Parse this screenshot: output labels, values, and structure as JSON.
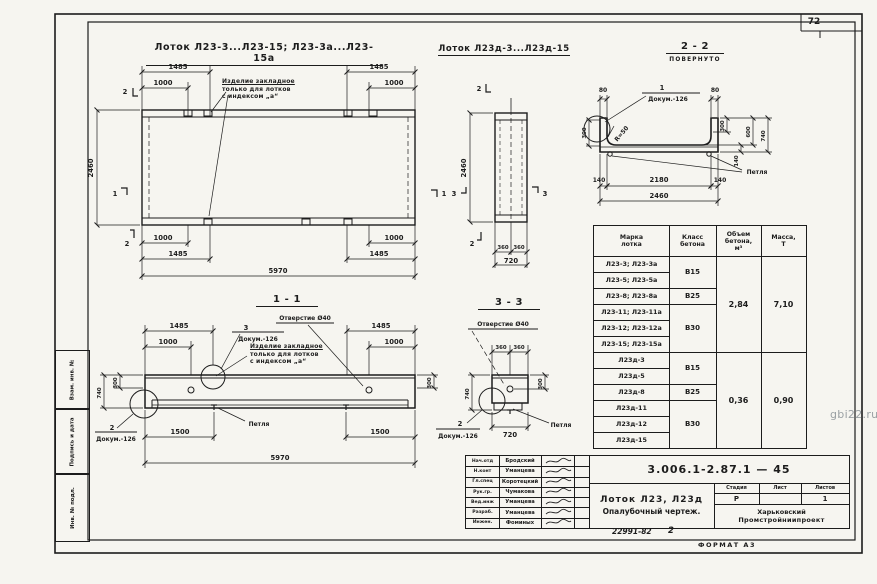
{
  "page": {
    "sheet_number": "72",
    "watermark": "gbi22.ru",
    "footer_doc": "22991-82",
    "footer_sheet": "2",
    "format_label": "ФОРМАТ А3"
  },
  "frame": {
    "stamps": [
      "Взам. инв. №",
      "Подпись и дата",
      "Инв. № подл."
    ]
  },
  "titles": {
    "plan": "Лоток Л23-3...Л23-15; Л23-3а...Л23-15а",
    "plan_d": "Лоток Л23д-3...Л23д-15",
    "s22": "2 - 2",
    "s22_note": "ПОВЕРНУТО",
    "s11": "1 - 1",
    "s33": "3 - 3"
  },
  "plan": {
    "note1": "Изделие закладное",
    "note2": "только для лотков",
    "note3": "с индексом „а“",
    "dims": {
      "tl1": "1485",
      "tl2": "1000",
      "tr1": "1485",
      "tr2": "1000",
      "height": "2460",
      "bl1": "1000",
      "bl2": "1485",
      "br1": "1000",
      "br2": "1485",
      "total": "5970"
    },
    "marks": {
      "m1": "1",
      "m2": "2"
    }
  },
  "end_view": {
    "dims": {
      "height": "2460",
      "half1": "360",
      "half2": "360",
      "width": "720"
    },
    "marks": {
      "m2": "2",
      "m3": "3"
    }
  },
  "s22": {
    "callout_num": "1",
    "callout_doc": "Докум.-126",
    "radius": "R=50",
    "loop_label": "Петля",
    "dims": {
      "w_left": "80",
      "w_right": "80",
      "left_300": "300",
      "r_300": "300",
      "r_600": "600",
      "r_140": "140",
      "r_740": "740",
      "b_140l": "140",
      "b_2180": "2180",
      "b_140r": "140",
      "b_total": "2460"
    }
  },
  "s11": {
    "hole_label": "Отверстие Ø40",
    "callout3_num": "3",
    "callout3_doc": "Докум.-126",
    "note1": "Изделие закладное",
    "note2": "только для лотков",
    "note3": "с индексом „а“",
    "loop_label": "Петля",
    "callout2_num": "2",
    "callout2_doc": "Докум.-126",
    "dims": {
      "tl1": "1485",
      "tl2": "1000",
      "tr1": "1485",
      "tr2": "1000",
      "l300": "300",
      "l740": "740",
      "r300": "300",
      "bl": "1500",
      "br": "1500",
      "total": "5970"
    }
  },
  "s33": {
    "hole_label": "Отверстие Ø40",
    "loop_label": "Петля",
    "callout2_num": "2",
    "callout2_doc": "Докум.-126",
    "dims": {
      "a": "360",
      "b": "360",
      "h740": "740",
      "r300": "300",
      "w720": "720"
    }
  },
  "table": {
    "headers": [
      "Марка\nлотка",
      "Класс\nбетона",
      "Объем\nбетона,\nм³",
      "Масса,\nТ"
    ],
    "rows": [
      "Л23-3; Л23-3а",
      "Л23-5; Л23-5а",
      "Л23-8; Л23-8а",
      "Л23-11; Л23-11а",
      "Л23-12; Л23-12а",
      "Л23-15; Л23-15а",
      "Л23д-3",
      "Л23д-5",
      "Л23д-8",
      "Л23д-11",
      "Л23д-12",
      "Л23д-15"
    ],
    "classes": [
      "В15",
      "В25",
      "В30",
      "В15",
      "В25",
      "В30"
    ],
    "volumes": [
      "2,84",
      "0,36"
    ],
    "masses": [
      "7,10",
      "0,90"
    ]
  },
  "titleblock": {
    "doc_number": "3.006.1-2.87.1 — 45",
    "people": [
      {
        "role": "Нач.отд",
        "name": "Бродский"
      },
      {
        "role": "Н.конт",
        "name": "Уманцева"
      },
      {
        "role": "Гл.спец",
        "name": "Коротецкий"
      },
      {
        "role": "Рук.гр.",
        "name": "Чумакова"
      },
      {
        "role": "Вед.инж",
        "name": "Уманцева"
      },
      {
        "role": "Разраб.",
        "name": "Уманцева"
      },
      {
        "role": "Инжен.",
        "name": "Фоминых"
      }
    ],
    "stage_headers": [
      "Стадия",
      "Лист",
      "Листов"
    ],
    "stage": "Р",
    "sheet": "",
    "sheets": "1",
    "title_line1": "Лоток Л23, Л23д",
    "title_line2": "Опалубочный чертеж.",
    "org_line1": "Харьковский",
    "org_line2": "Промстройниипроект"
  }
}
